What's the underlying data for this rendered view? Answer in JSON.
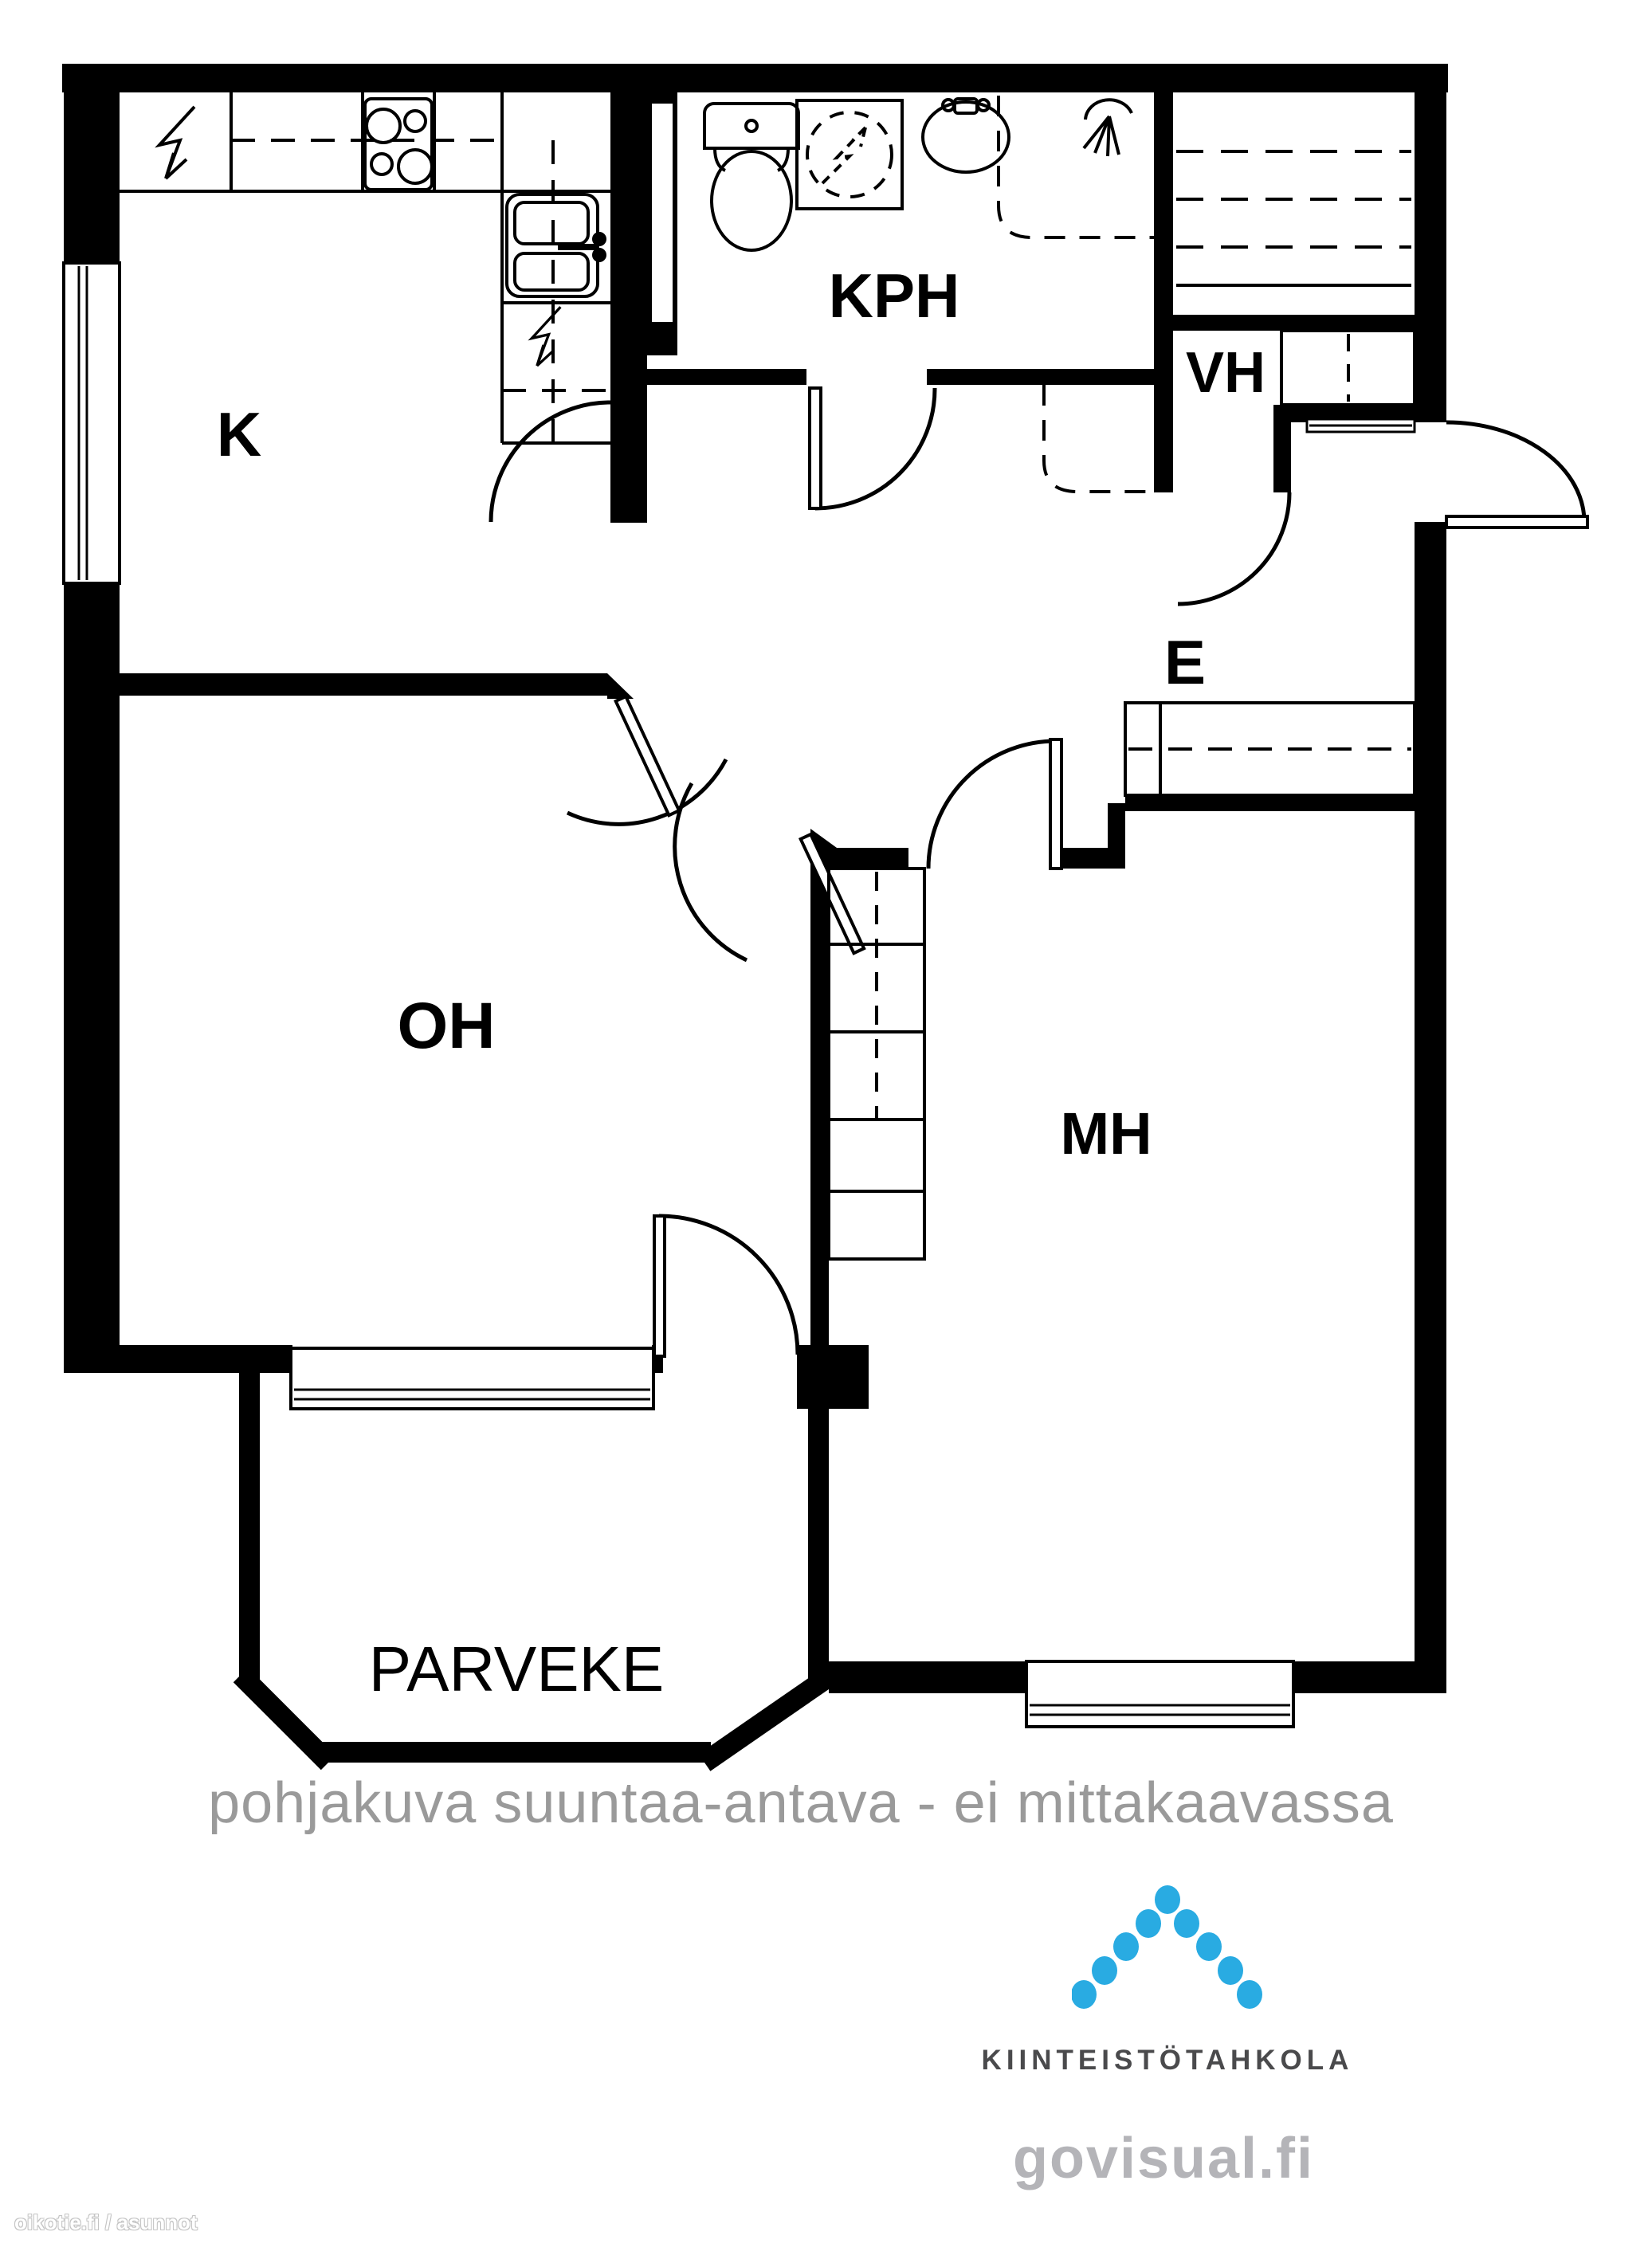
{
  "meta": {
    "background": "#ffffff",
    "wall_color": "#000000",
    "caption_color": "#9a9a9a",
    "logo_text_color": "#4a4a4c",
    "site_text_color": "#b4b4b8",
    "logo_dot_color": "#29abe2"
  },
  "floor_plan": {
    "rooms": [
      {
        "id": "kitchen",
        "label": "K"
      },
      {
        "id": "bathroom",
        "label": "KPH"
      },
      {
        "id": "walk-in-closet",
        "label": "VH"
      },
      {
        "id": "entry-hall",
        "label": "E"
      },
      {
        "id": "living-room",
        "label": "OH"
      },
      {
        "id": "bedroom",
        "label": "MH"
      },
      {
        "id": "balcony",
        "label": "PARVEKE"
      }
    ],
    "fixtures": [
      "electrical-icon",
      "stove-icon",
      "kitchen-sink-icon",
      "toilet-icon",
      "washing-machine-icon",
      "bathroom-sink-icon",
      "shower-icon",
      "wardrobe",
      "shelving",
      "window",
      "door-arc"
    ]
  },
  "caption": {
    "text": "pohjakuva suuntaa-antava - ei mittakaavassa"
  },
  "branding": {
    "company": "KIINTEISTÖTAHKOLA",
    "website": "govisual.fi"
  },
  "watermark": {
    "text": "oikotie.fi / asunnot"
  }
}
